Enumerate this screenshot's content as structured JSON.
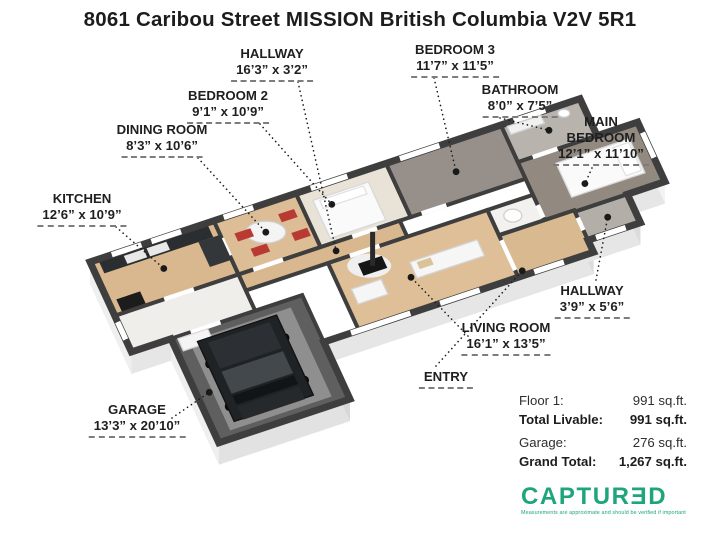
{
  "title": "8061 Caribou Street MISSION British Columbia V2V 5R1",
  "floorplan": {
    "origin": [
      90,
      262
    ],
    "axisA": [
      9.9,
      -3.3
    ],
    "axisB": [
      2.3,
      5.0
    ],
    "wall_h": 22,
    "wall_color": "#3e3e3e",
    "footprint": [
      [
        0,
        0
      ],
      [
        49.5,
        0
      ],
      [
        49.5,
        7.4
      ],
      [
        53.6,
        7.4
      ],
      [
        53.6,
        19.3
      ],
      [
        49.8,
        19.3
      ],
      [
        49.8,
        25
      ],
      [
        44.5,
        25
      ],
      [
        44.5,
        27.4
      ],
      [
        17.25,
        27.4
      ],
      [
        17.25,
        38.8
      ],
      [
        4,
        38.8
      ],
      [
        4,
        18
      ],
      [
        0,
        18
      ]
    ],
    "faces": [
      {
        "e": [
          0,
          0,
          0,
          18
        ],
        "fill": "#efefef"
      },
      {
        "e": [
          0,
          18,
          4,
          18
        ],
        "fill": "#e6e6e6"
      },
      {
        "e": [
          4,
          18,
          4,
          38.8
        ],
        "fill": "#efefef"
      },
      {
        "e": [
          4,
          38.8,
          17.25,
          38.8
        ],
        "fill": "#e2e2e2"
      },
      {
        "e": [
          17.25,
          38.8,
          17.25,
          27.4
        ],
        "fill": "#d8d8d8"
      },
      {
        "e": [
          17.25,
          27.4,
          44.5,
          27.4
        ],
        "fill": "#e6e6e6"
      },
      {
        "e": [
          44.5,
          27.4,
          44.5,
          25
        ],
        "fill": "#dcdcdc"
      },
      {
        "e": [
          44.5,
          25,
          49.8,
          25
        ],
        "fill": "#e6e6e6"
      },
      {
        "e": [
          49.8,
          25,
          49.8,
          19.3
        ],
        "fill": "#dcdcdc"
      },
      {
        "e": [
          49.8,
          19.3,
          53.6,
          19.3
        ],
        "fill": "#e6e6e6"
      },
      {
        "e": [
          53.6,
          19.3,
          53.6,
          7.4
        ],
        "fill": "#f3f3f3"
      }
    ],
    "rooms": [
      {
        "id": "kitchen",
        "rect": [
          0,
          0,
          12.5,
          10.75
        ],
        "fill": "#d9b88f"
      },
      {
        "id": "dining-room",
        "rect": [
          12.5,
          0,
          8.3,
          10.75
        ],
        "fill": "#dcbd96"
      },
      {
        "id": "bedroom-2",
        "rect": [
          20.8,
          0,
          9.1,
          10.75
        ],
        "fill": "#e9e2d6"
      },
      {
        "id": "bedroom-3",
        "rect": [
          29.9,
          0,
          11.6,
          10.75
        ],
        "fill": "#97908a"
      },
      {
        "id": "bathroom",
        "rect": [
          41.5,
          0,
          8,
          7.4
        ],
        "fill": "#b8b3ac"
      },
      {
        "id": "main-bedroom",
        "rect": [
          41.5,
          7.4,
          12.1,
          11.9
        ],
        "fill": "#928a80"
      },
      {
        "id": "hallway-1",
        "rect": [
          12.5,
          10.75,
          16.3,
          3.2
        ],
        "fill": "#d9b88f"
      },
      {
        "id": "mudroom",
        "rect": [
          0,
          10.75,
          12.5,
          7.25
        ],
        "fill": "#f0eeea"
      },
      {
        "id": "living-room",
        "rect": [
          20.8,
          13.95,
          16.1,
          13.45
        ],
        "fill": "#debf98"
      },
      {
        "id": "closet",
        "rect": [
          36.9,
          13.95,
          4.6,
          5.05
        ],
        "fill": "#f2f1ef"
      },
      {
        "id": "entry",
        "rect": [
          36.9,
          19,
          7.6,
          8.4
        ],
        "fill": "#d9ba90"
      },
      {
        "id": "hallway-2",
        "rect": [
          44.5,
          19.3,
          5.3,
          5.7
        ],
        "fill": "#b3aea7"
      },
      {
        "id": "garage",
        "rect": [
          4,
          18,
          13.25,
          20.8
        ],
        "fill": "#5f5f5f"
      }
    ],
    "openings": [
      [
        12.5,
        3.5,
        12.5,
        7
      ],
      [
        5,
        10.75,
        8,
        10.75
      ],
      [
        14,
        10.75,
        17,
        10.75
      ],
      [
        24,
        10.75,
        26.5,
        10.75
      ],
      [
        31,
        10.75,
        33.5,
        10.75
      ],
      [
        23,
        13.95,
        26,
        13.95
      ],
      [
        43,
        7.4,
        45.5,
        7.4
      ],
      [
        41.5,
        16,
        41.5,
        18.5
      ],
      [
        44.5,
        20.5,
        44.5,
        23
      ],
      [
        6,
        18,
        9,
        18
      ],
      [
        36.9,
        20,
        36.9,
        26
      ]
    ],
    "windows": [
      [
        2.2,
        0,
        5.2,
        0
      ],
      [
        6.2,
        0,
        9.2,
        0
      ],
      [
        13.5,
        0,
        16.5,
        0
      ],
      [
        22.3,
        0,
        26,
        0
      ],
      [
        31.3,
        0,
        35.3,
        0
      ],
      [
        42.8,
        0,
        46,
        0
      ],
      [
        53.6,
        9.5,
        53.6,
        14.5
      ],
      [
        45.3,
        25,
        48.3,
        25
      ],
      [
        20,
        27.4,
        26,
        27.4
      ],
      [
        29,
        27.4,
        33,
        27.4
      ],
      [
        38.5,
        27.4,
        41.5,
        27.4
      ],
      [
        0,
        12,
        0,
        15.5
      ]
    ],
    "furniture": [
      {
        "shape": "rect",
        "rect": [
          5.5,
          19.5,
          10.25,
          17.8
        ],
        "fill": "#8f8f8f"
      },
      {
        "shape": "rect",
        "rect": [
          4.6,
          18.4,
          3,
          2.4
        ],
        "fill": "#f4f4f4",
        "stroke": "#d9d9d9"
      },
      {
        "shape": "ellipse",
        "a": 6.3,
        "b": 24.5,
        "rx": 3.5,
        "ry": 4.5,
        "fill": "#0b0b0b"
      },
      {
        "shape": "ellipse",
        "a": 6.3,
        "b": 33,
        "rx": 3.5,
        "ry": 4.5,
        "fill": "#0b0b0b"
      },
      {
        "shape": "ellipse",
        "a": 14.1,
        "b": 24.5,
        "rx": 3.5,
        "ry": 4.5,
        "fill": "#0b0b0b"
      },
      {
        "shape": "ellipse",
        "a": 14.1,
        "b": 33,
        "rx": 3.5,
        "ry": 4.5,
        "fill": "#0b0b0b"
      },
      {
        "shape": "rect",
        "rect": [
          6.2,
          20,
          8,
          16
        ],
        "fill": "#202325",
        "stroke": "#101112"
      },
      {
        "shape": "rect",
        "rect": [
          7.1,
          20.8,
          6.2,
          5.2
        ],
        "fill": "#2c3034"
      },
      {
        "shape": "rect",
        "rect": [
          7.1,
          26.6,
          6.2,
          4.4
        ],
        "fill": "#43484c"
      },
      {
        "shape": "rect",
        "rect": [
          7.1,
          31.4,
          6.2,
          1.8
        ],
        "fill": "#111518"
      },
      {
        "shape": "rect",
        "rect": [
          7.1,
          33.6,
          6.2,
          2.6
        ],
        "fill": "#26292c"
      },
      {
        "shape": "rect",
        "rect": [
          0.8,
          0.6,
          11,
          2.2
        ],
        "fill": "#2b2e30"
      },
      {
        "shape": "rect",
        "rect": [
          10.3,
          2.8,
          2.2,
          5
        ],
        "fill": "#33373a"
      },
      {
        "shape": "rect",
        "rect": [
          0.8,
          8,
          2.4,
          2.4
        ],
        "fill": "#1c1c1c"
      },
      {
        "shape": "rect",
        "rect": [
          3.2,
          0.9,
          2,
          1.6
        ],
        "fill": "#e8e8e8"
      },
      {
        "shape": "rect",
        "rect": [
          5.5,
          0.9,
          2,
          1.6
        ],
        "fill": "#e8e8e8"
      },
      {
        "shape": "ellipse",
        "a": 16.6,
        "b": 5,
        "rx": 20,
        "ry": 11,
        "fill": "#f4f4f4",
        "stroke": "#cfcfcf"
      },
      {
        "shape": "rect",
        "rect": [
          13.8,
          3.4,
          1.6,
          1.6
        ],
        "fill": "#b93a32"
      },
      {
        "shape": "rect",
        "rect": [
          18.4,
          2.6,
          1.6,
          1.6
        ],
        "fill": "#b93a32"
      },
      {
        "shape": "rect",
        "rect": [
          14.6,
          7,
          1.6,
          1.6
        ],
        "fill": "#b93a32"
      },
      {
        "shape": "rect",
        "rect": [
          18.8,
          6.6,
          1.6,
          1.6
        ],
        "fill": "#b93a32"
      },
      {
        "shape": "rect",
        "rect": [
          22,
          2.2,
          5.6,
          7.6
        ],
        "fill": "#fafafa",
        "stroke": "#d8d8d8"
      },
      {
        "shape": "rect",
        "rect": [
          22.6,
          2.6,
          4.4,
          1.6
        ],
        "fill": "#ffffff",
        "stroke": "#e2e2e2"
      },
      {
        "shape": "rect",
        "rect": [
          44.8,
          9.8,
          7.4,
          6.8
        ],
        "fill": "#fafafa",
        "stroke": "#d8d8d8"
      },
      {
        "shape": "rect",
        "rect": [
          50.4,
          10.4,
          1.6,
          5.6
        ],
        "fill": "#ffffff",
        "stroke": "#e2e2e2"
      },
      {
        "shape": "rect",
        "rect": [
          42,
          0.6,
          3.4,
          1.6
        ],
        "fill": "#f1f1f1",
        "stroke": "#d0d0d0"
      },
      {
        "shape": "ellipse",
        "a": 47.5,
        "b": 1.6,
        "rx": 6,
        "ry": 4,
        "fill": "#ffffff",
        "stroke": "#cccccc"
      },
      {
        "shape": "ellipse",
        "a": 24.3,
        "b": 16.8,
        "rx": 22,
        "ry": 12,
        "fill": "#efefef"
      },
      {
        "shape": "rect",
        "rect": [
          23.4,
          15.8,
          2.4,
          2.4
        ],
        "fill": "#161616"
      },
      {
        "shape": "vline",
        "a": 24.6,
        "b": 17,
        "h": 34,
        "stroke": "#2a2a2a",
        "w": 5
      },
      {
        "shape": "rect",
        "rect": [
          28,
          18.5,
          6.8,
          3.2
        ],
        "fill": "#f6f6f6",
        "stroke": "#d4d4d4"
      },
      {
        "shape": "rect",
        "rect": [
          28.6,
          18.9,
          1.4,
          1.4
        ],
        "fill": "#d9c49a"
      },
      {
        "shape": "rect",
        "rect": [
          21.8,
          19.8,
          3,
          3
        ],
        "fill": "#f6f6f6",
        "stroke": "#d4d4d4"
      },
      {
        "shape": "ellipse",
        "a": 38.9,
        "b": 16.4,
        "rx": 9,
        "ry": 6.5,
        "fill": "#fdfdfd",
        "stroke": "#cfcfcf"
      }
    ]
  },
  "labels": [
    {
      "id": "hallway-1",
      "lines": [
        "HALLWAY"
      ],
      "dims": "16’3” x 3’2”",
      "x": 272,
      "y": 46,
      "lx": 298,
      "ly": 82,
      "pa": 22,
      "pb": 12.3
    },
    {
      "id": "bedroom-3",
      "lines": [
        "BEDROOM 3"
      ],
      "dims": "11’7” x 11’5”",
      "x": 455,
      "y": 42,
      "lx": 434,
      "ly": 78,
      "pa": 35.7,
      "pb": 5.5
    },
    {
      "id": "bedroom-2",
      "lines": [
        "BEDROOM 2"
      ],
      "dims": "9’1” x 10’9”",
      "x": 228,
      "y": 88,
      "lx": 260,
      "ly": 124,
      "pa": 23.5,
      "pb": 4
    },
    {
      "id": "bathroom",
      "lines": [
        "BATHROOM"
      ],
      "dims": "8’0” x 7’5”",
      "x": 520,
      "y": 82,
      "lx": 500,
      "ly": 118,
      "pa": 45.5,
      "pb": 3.7
    },
    {
      "id": "dining-room",
      "lines": [
        "DINING ROOM"
      ],
      "dims": "8’3” x 10’6”",
      "x": 162,
      "y": 122,
      "lx": 198,
      "ly": 158,
      "pa": 16.6,
      "pb": 5
    },
    {
      "id": "main-bedroom",
      "lines": [
        "MAIN",
        "BEDROOM"
      ],
      "dims": "12’1” x 11’10”",
      "x": 601,
      "y": 114,
      "lx": 592,
      "ly": 168,
      "pa": 46.5,
      "pb": 15
    },
    {
      "id": "kitchen",
      "lines": [
        "KITCHEN"
      ],
      "dims": "12’6” x 10’9”",
      "x": 82,
      "y": 191,
      "lx": 116,
      "ly": 227,
      "pa": 6.2,
      "pb": 5.4
    },
    {
      "id": "hallway-2",
      "lines": [
        "HALLWAY"
      ],
      "dims": "3’9” x 5’6”",
      "x": 592,
      "y": 283,
      "lx": 596,
      "ly": 280,
      "pa": 47.15,
      "pb": 22.15
    },
    {
      "id": "living-room",
      "lines": [
        "LIVING ROOM"
      ],
      "dims": "16’1” x 13’5”",
      "x": 506,
      "y": 320,
      "lx": 468,
      "ly": 336,
      "pa": 27.5,
      "pb": 21.2
    },
    {
      "id": "entry",
      "lines": [
        "ENTRY"
      ],
      "dims": null,
      "x": 446,
      "y": 369,
      "lx": 436,
      "ly": 366,
      "pa": 37.5,
      "pb": 26.5
    },
    {
      "id": "garage",
      "lines": [
        "GARAGE"
      ],
      "dims": "13’3” x 20’10”",
      "x": 137,
      "y": 402,
      "lx": 172,
      "ly": 418,
      "pa": 5.2,
      "pb": 29.5
    }
  ],
  "summary": {
    "rows": [
      {
        "label": "Floor 1:",
        "value": "991 sq.ft."
      },
      {
        "label": "Total Livable:",
        "value": "991 sq.ft."
      },
      {
        "label": "Garage:",
        "value": "276 sq.ft."
      },
      {
        "label": "Grand Total:",
        "value": "1,267 sq.ft."
      }
    ]
  },
  "brand": {
    "name": "CAPTURƎD",
    "tagline": "Measurements are approximate and should be verified if important",
    "color": "#1fa57c"
  }
}
